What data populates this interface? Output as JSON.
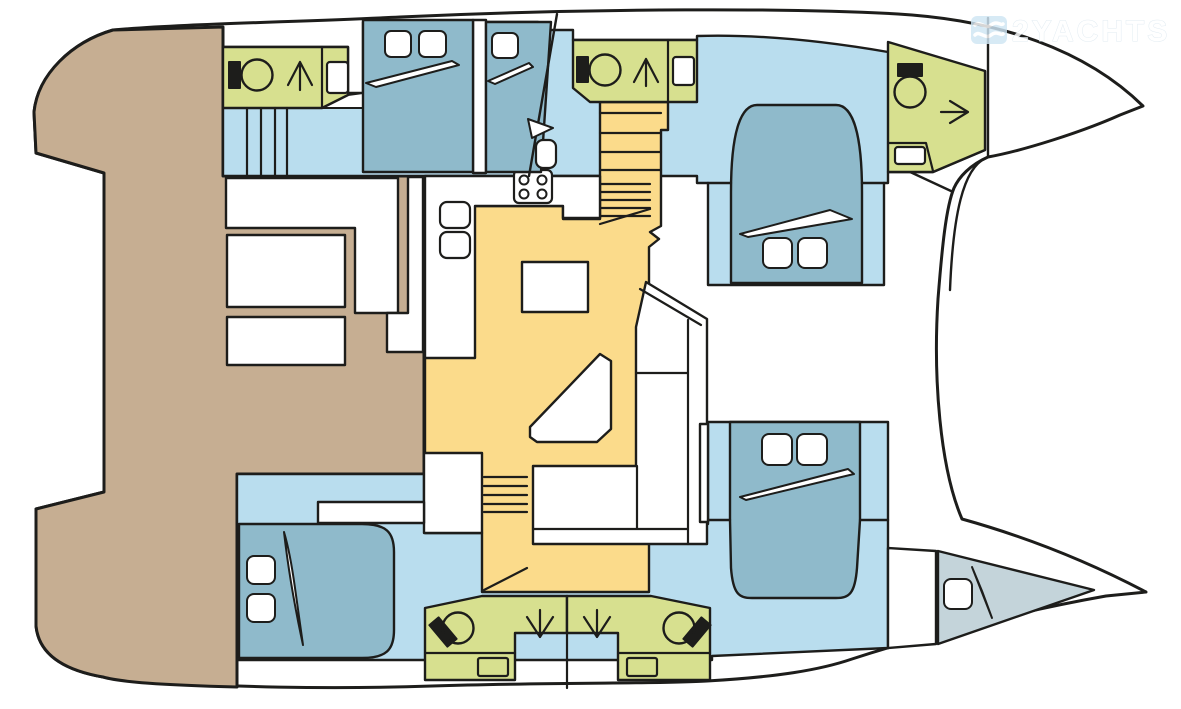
{
  "watermark": {
    "text": "2YACHTS",
    "icon": "waves-flag-icon"
  },
  "palette": {
    "line": "#1d1d1b",
    "hull_white": "#ffffff",
    "deck_tan": "#c6ae92",
    "floor_blue": "#b9ddee",
    "bed_blue": "#8fbacb",
    "bathroom_green": "#d7e08f",
    "salon_yellow": "#fbdb8b",
    "crew_gray": "#c4d4da",
    "fixture_white": "#ffffff",
    "toilet_tank_black": "#1d1d1b",
    "watermark_icon_blue": "#cfe6f4",
    "watermark_text": "#ffffff",
    "watermark_outline": "#dbe7ef"
  },
  "plan": {
    "vessel_type": "catamaran-deck-plan",
    "orientation": "bows-right",
    "areas": [
      {
        "name": "aft-cockpit-deck",
        "color": "deck_tan",
        "fixtures": [
          "l-shaped-bench",
          "side-bench",
          "cockpit-table",
          "aft-bench"
        ]
      },
      {
        "name": "salon-bridgedeck",
        "color": "salon_yellow",
        "fixtures": [
          "galley-counter",
          "double-sink",
          "stove-4-burners",
          "dining-table",
          "chaise-seat",
          "l-shaped-sofa",
          "companionway-stairs-forward",
          "companionway-stairs-aft"
        ]
      },
      {
        "name": "port-aft-head",
        "color": "bathroom_green",
        "fixtures": [
          "toilet",
          "shower",
          "sink"
        ]
      },
      {
        "name": "port-aft-steps",
        "color": "floor_blue",
        "fixtures": [
          "stairs"
        ]
      },
      {
        "name": "port-aft-cabin",
        "color": "bed_blue",
        "beds": 1,
        "pillows": 2
      },
      {
        "name": "port-mid-berth",
        "color": "bed_blue",
        "beds": 1,
        "pillows": 1
      },
      {
        "name": "port-forward-head",
        "color": "bathroom_green",
        "fixtures": [
          "toilet",
          "shower",
          "sink"
        ]
      },
      {
        "name": "port-forward-cabin",
        "color": "bed_blue",
        "beds": 1,
        "pillows": 2
      },
      {
        "name": "port-bow-head",
        "color": "bathroom_green",
        "fixtures": [
          "toilet",
          "shower",
          "sink"
        ]
      },
      {
        "name": "starboard-aft-cabin",
        "color": "bed_blue",
        "beds": 1,
        "pillows": 2
      },
      {
        "name": "starboard-mid-head-aft",
        "color": "bathroom_green",
        "fixtures": [
          "toilet",
          "shower",
          "sink"
        ]
      },
      {
        "name": "starboard-mid-head-forward",
        "color": "bathroom_green",
        "fixtures": [
          "toilet",
          "shower",
          "sink"
        ]
      },
      {
        "name": "starboard-forward-cabin",
        "color": "bed_blue",
        "beds": 1,
        "pillows": 2
      },
      {
        "name": "starboard-bow-berth",
        "color": "crew_gray",
        "beds": 1,
        "pillows": 1
      },
      {
        "name": "mast",
        "color": "line"
      }
    ]
  }
}
